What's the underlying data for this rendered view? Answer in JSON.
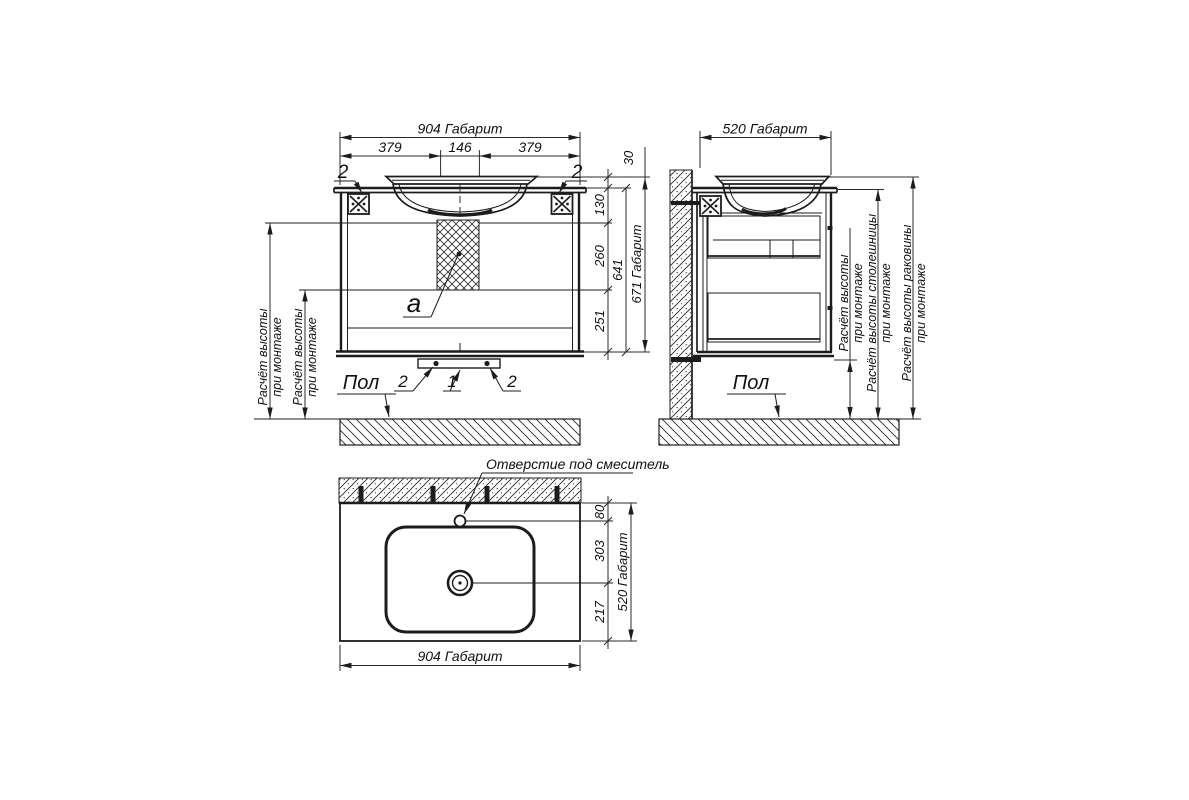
{
  "front_view": {
    "width_total": "904 Габарит",
    "width_seg_left": "379",
    "width_seg_center": "146",
    "width_seg_right": "379",
    "h_30": "30",
    "h_130": "130",
    "h_260": "260",
    "h_251": "251",
    "h_641": "641",
    "h_671": "671 Габарит",
    "detail_a": "a",
    "callout_bracket_left": "2",
    "callout_bracket_right": "2",
    "callout_foot_left": "2",
    "callout_center": "1",
    "callout_foot_right": "2",
    "floor": "Пол",
    "mount_note_l1": "Расчёт высоты",
    "mount_note_l2": "при монтаже"
  },
  "side_view": {
    "depth_total": "520 Габарит",
    "floor": "Пол",
    "note_height_l1": "Расчёт высоты",
    "note_height_l2": "при монтаже",
    "note_countertop_l1": "Расчёт высоты столешницы",
    "note_countertop_l2": "при монтаже",
    "note_sink_l1": "Расчёт высоты раковины",
    "note_sink_l2": "при монтаже"
  },
  "top_view": {
    "faucet_hole": "Отверстие под смеситель",
    "d_80": "80",
    "d_303": "303",
    "d_217": "217",
    "depth_total": "520 Габарит",
    "width_total": "904 Габарит"
  }
}
